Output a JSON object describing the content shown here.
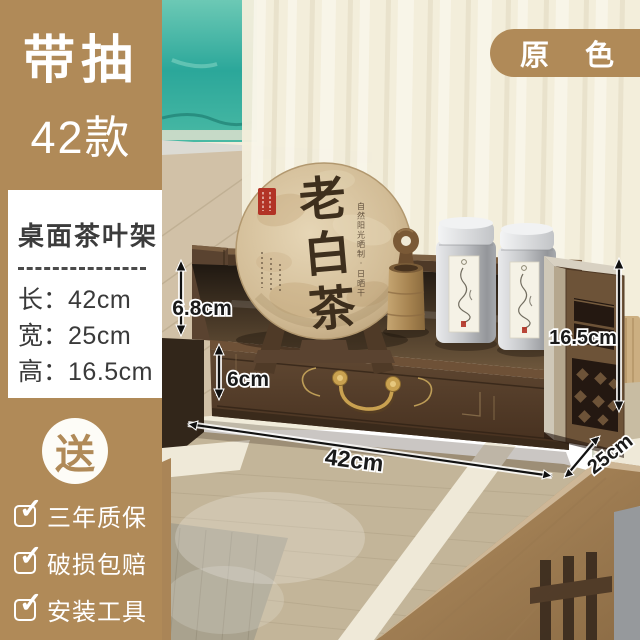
{
  "page": {
    "title_badge_line1": "带抽",
    "title_badge_line2": "42款",
    "variant_badge": "原 色"
  },
  "sidebar": {
    "product_title": "桌面茶叶架",
    "dimensions": [
      {
        "label": "长：",
        "value": "42cm"
      },
      {
        "label": "宽：",
        "value": "25cm"
      },
      {
        "label": "高：",
        "value": "16.5cm"
      }
    ],
    "gift_badge": "送",
    "checkmark": "✓",
    "features": [
      {
        "text": "三年质保"
      },
      {
        "text": "破损包赔"
      },
      {
        "text": "安装工具"
      }
    ]
  },
  "scene": {
    "annotations": {
      "rail_height": "6.8cm",
      "drawer_height": "6cm",
      "width": "42cm",
      "depth": "25cm",
      "total_height": "16.5cm"
    },
    "tea_cake": {
      "name": "老白茶",
      "side_note": "自然阳光晒制·日晒干"
    }
  },
  "colors": {
    "brand_brown": "#b08a58",
    "walnut_dark": "#4e3927",
    "text_dark": "#3a3a3a"
  }
}
